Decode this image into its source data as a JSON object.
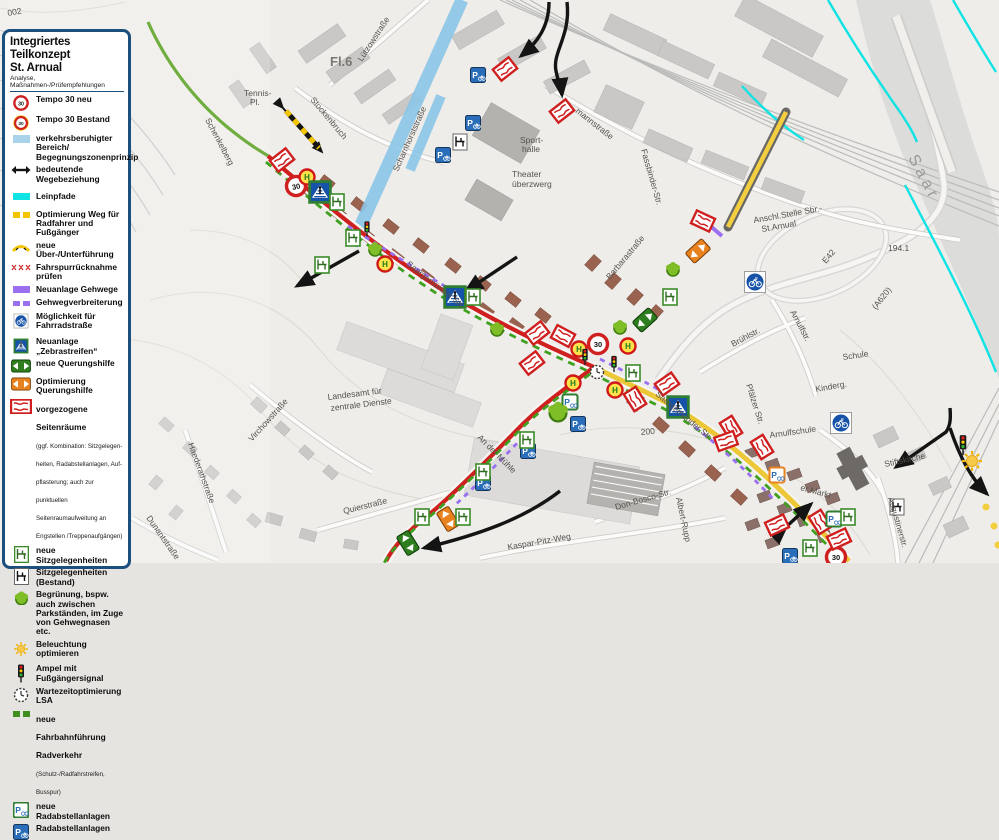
{
  "legend": {
    "title": "Integriertes Teilkonzept",
    "title2": "St. Arnual",
    "subtitle": "Analyse, Maßnahmen-/Prüfempfehlungen",
    "items": [
      {
        "icon": "tempo-30-neu-icon",
        "label": "Tempo 30 neu"
      },
      {
        "icon": "tempo-30-bestand-icon",
        "label": "Tempo 30 Bestand"
      },
      {
        "icon": "traffic-calmed-area-swatch",
        "label": "verkehrsberuhigter Bereich/ Begegnungszonenprinzip"
      },
      {
        "icon": "important-route-arrow-icon",
        "label": "bedeutende Wegebeziehung"
      },
      {
        "icon": "towpath-swatch",
        "label": "Leinpfade"
      },
      {
        "icon": "path-optimization-swatch",
        "label": "Optimierung Weg für Radfahrer und Fußgänger"
      },
      {
        "icon": "new-underpass-icon",
        "label": "neue Über-/Unterführung"
      },
      {
        "icon": "lane-reduction-icon",
        "label": "Fahrspurrücknahme prüfen"
      },
      {
        "icon": "new-sidewalk-swatch",
        "label": "Neuanlage Gehwege"
      },
      {
        "icon": "sidewalk-widening-swatch",
        "label": "Gehwegverbreiterung"
      },
      {
        "icon": "bicycle-street-sign-icon",
        "label": "Möglichkeit für Fahrradstraße"
      },
      {
        "icon": "zebra-crossing-sign-icon",
        "label": "Neuanlage „Zebrastreifen“"
      },
      {
        "icon": "new-crossing-aid-icon",
        "label": "neue Querungshilfe"
      },
      {
        "icon": "crossing-aid-optimization-icon",
        "label": "Optimierung Querungshilfe"
      },
      {
        "icon": "advanced-side-space-icon",
        "label": "vorgezogene Seitenräume",
        "sublabel": "(ggf. Kombination: Sitzgelegen- heiten, Radabstellanlagen, Auf- pflasterung; auch zur punktuellen Seitenraumaufweitung an Engstellen /Treppenaufgängen)"
      },
      {
        "icon": "new-seating-icon",
        "label": "neue Sitzgelegenheiten"
      },
      {
        "icon": "existing-seating-icon",
        "label": "Sitzgelegenheiten (Bestand)"
      },
      {
        "icon": "greening-icon",
        "label": "Begrünung, bspw. auch zwischen Parkständen, im Zuge von Gehwegnasen etc."
      },
      {
        "icon": "lighting-icon",
        "label": "Beleuchtung optimieren"
      },
      {
        "icon": "pedestrian-signal-icon",
        "label": "Ampel mit Fußgängersignal"
      },
      {
        "icon": "wait-time-optimization-icon",
        "label": "Wartezeitoptimierung LSA"
      },
      {
        "icon": "new-bike-lane-swatch",
        "label": "neue Fahrbahnführung Radverkehr",
        "sublabel": "(Schutz-/Radfahrstreifen, Busspur)"
      },
      {
        "icon": "new-bike-parking-icon",
        "label": "neue Radabstellanlagen"
      },
      {
        "icon": "bike-parking-icon",
        "label": "Radabstellanlagen"
      }
    ]
  },
  "icons": {
    "p": "P",
    "h": "H",
    "tempo": "30"
  },
  "map": {
    "colors": {
      "route_red": "#cf2020",
      "bike_lane_green": "#3f9f1f",
      "calmed_zone_blue": "#8cc6e8",
      "towpath_cyan": "#0fe3e3",
      "path_yellow": "#ecc737",
      "sidewalk_purple": "#9a6ff0"
    },
    "labels": [
      {
        "text": "002"
      },
      {
        "text": "Lützowstraße"
      },
      {
        "text": "Fl.6"
      },
      {
        "text": "Tennis-"
      },
      {
        "text": "Pl."
      },
      {
        "text": "Stockenbruch"
      },
      {
        "text": "Schenkelberg"
      },
      {
        "text": "Scharnhorststraße"
      },
      {
        "text": "Sport-"
      },
      {
        "text": "halle"
      },
      {
        "text": "Theater"
      },
      {
        "text": "überzwerg"
      },
      {
        "text": "mannstraße"
      },
      {
        "text": "Fassbinder-Str."
      },
      {
        "text": "Saar"
      },
      {
        "text": "Saargemünder Str."
      },
      {
        "text": "Barbarastraße"
      },
      {
        "text": "Brühlstr."
      },
      {
        "text": "Arnulfstr."
      },
      {
        "text": "Arnulfschule"
      },
      {
        "text": "Schule"
      },
      {
        "text": "Kinderg."
      },
      {
        "text": "Stiftskirche"
      },
      {
        "text": "Augustinerstr."
      },
      {
        "text": "Pfälzer Str."
      },
      {
        "text": "Don-Bosco-Str."
      },
      {
        "text": "Albert-Rupp"
      },
      {
        "text": "Kaspar-Pitz-Weg"
      },
      {
        "text": "Landesamt für"
      },
      {
        "text": "zentrale Dienste"
      },
      {
        "text": "Virchowstraße"
      },
      {
        "text": "Haederathstraße"
      },
      {
        "text": "Dunantstraße"
      },
      {
        "text": "Quierstraße"
      },
      {
        "text": "An der Mühle"
      },
      {
        "text": "E42"
      },
      {
        "text": "(A620)"
      },
      {
        "text": "194.1"
      },
      {
        "text": "200"
      },
      {
        "text": "Anschl.Stelle Sbr.-"
      },
      {
        "text": "St.Arnual"
      },
      {
        "text": "Saargemünder Str."
      },
      {
        "text": "er Markt"
      }
    ]
  }
}
